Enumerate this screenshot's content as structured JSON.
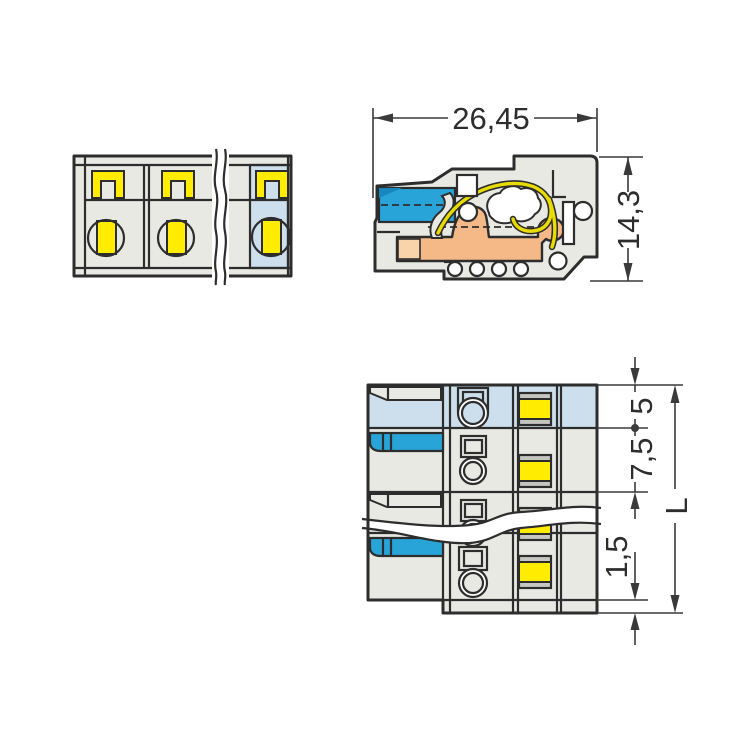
{
  "dimensions": {
    "side_width": "26,45",
    "side_height": "14,3",
    "first_pole_offset": "5",
    "pole_pitch": "7,5",
    "end_offset": "1,5",
    "total_length": "L"
  },
  "colors": {
    "background": "#ffffff",
    "housing": "#e9e9e4",
    "pole_highlight": "#cddfec",
    "wire_entry_blue": "#29a4d9",
    "dark_blue": "#1787bd",
    "marker_yellow": "#ffec00",
    "spring_yellow": "#e8dc00",
    "busbar_orange": "#f4b987",
    "busbar_orange_light": "#f9d4ab",
    "outline": "#2d2d2d",
    "dim_line": "#3a3a3a",
    "text": "#2d2d2d"
  }
}
